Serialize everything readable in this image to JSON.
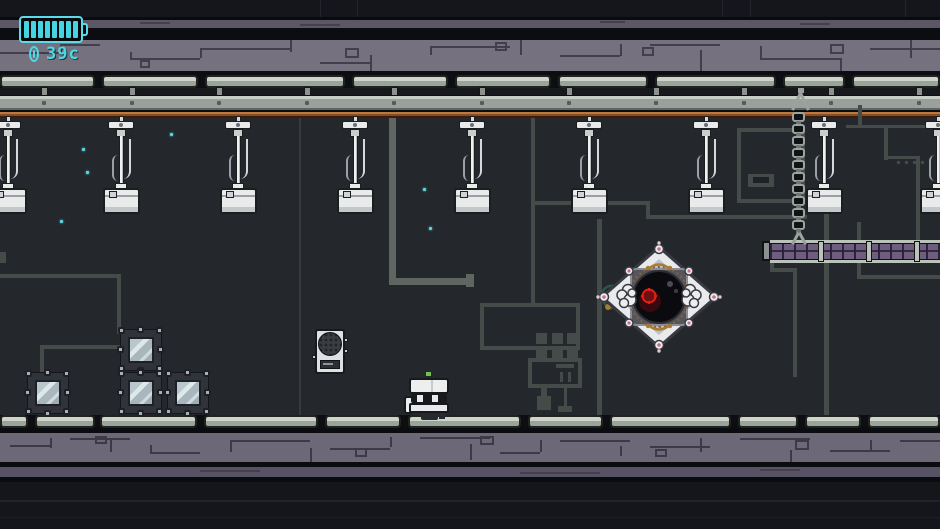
{
  "meta": {
    "app": "pixel-platformer-screenshot",
    "width": 940,
    "height": 529
  },
  "hud": {
    "battery": {
      "icon": "battery-icon",
      "segments_total": 8,
      "segments_filled": 8,
      "color": "#43d5e2"
    },
    "currency": {
      "icon": "coin-icon",
      "amount": "39c",
      "color": "#4cd9e5"
    }
  },
  "scene": {
    "lamps": {
      "entity": "hanging-lamp",
      "x_centers": [
        8,
        121,
        238,
        355,
        472,
        589,
        706,
        824,
        938
      ]
    },
    "crates": [
      {
        "x": 27,
        "y": 372
      },
      {
        "x": 120,
        "y": 329
      },
      {
        "x": 120,
        "y": 372
      },
      {
        "x": 167,
        "y": 372
      }
    ],
    "player": {
      "entity": "robot-player",
      "x": 405,
      "y": 370
    },
    "boss": {
      "entity": "hex-drone-boss",
      "x": 659,
      "y": 297
    },
    "speaker": {
      "entity": "wall-speaker",
      "x": 315,
      "y": 329
    },
    "chain": {
      "entity": "hanging-chain",
      "x": 792,
      "y_top": 88,
      "y_bottom": 245
    },
    "platform": {
      "entity": "right-platform",
      "x": 762,
      "y": 240,
      "width": 178
    },
    "particles": [
      [
        60,
        220
      ],
      [
        82,
        148
      ],
      [
        86,
        171
      ],
      [
        170,
        133
      ],
      [
        423,
        188
      ],
      [
        429,
        227
      ]
    ],
    "particle_color": "#59d8de"
  },
  "palette": {
    "play_bg": "#24272b",
    "navy": "#14161b",
    "black_band": "#0c0d11",
    "purple_light": "#76717f",
    "purple_medium": "#5b5765",
    "rail_light": "#cdd5cb",
    "rail_dark": "#9aa49a",
    "pipe": "#454b48",
    "pipe_light": "#5f6661",
    "orange_rail": "#b97a42",
    "platform_purple": "#6e5d7d",
    "white_metal": "#e9ebea",
    "accent_cyan": "#4cd9e5",
    "boss_red": "#e02017",
    "boss_gold": "#a97b2f",
    "antenna_green": "#72c14e"
  }
}
